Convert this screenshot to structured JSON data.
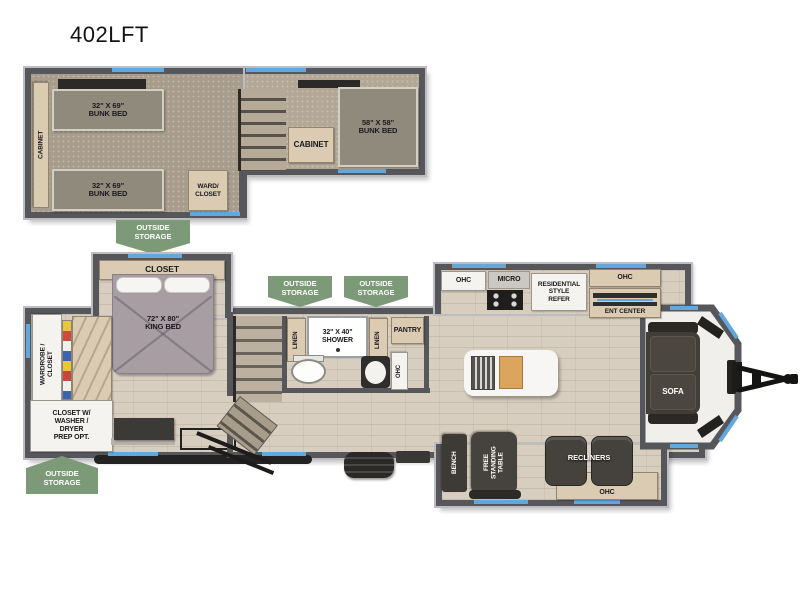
{
  "title": "402LFT",
  "banner": {
    "outside_storage": "OUTSIDE\nSTORAGE"
  },
  "loft": {
    "cabinet": "CABINET",
    "bunk_top": "32\" X 69\"\nBUNK BED",
    "bunk_bottom": "32\" X 69\"\nBUNK BED",
    "ward_closet": "WARD/\nCLOSET",
    "cabinet_mid": "CABINET",
    "bunk_right": "58\" X 58\"\nBUNK BED"
  },
  "bedroom": {
    "closet": "CLOSET",
    "king_bed": "72\" X 80\"\nKING BED",
    "wardrobe": "WARDROBE /\nCLOSET",
    "washer_closet": "CLOSET W/\nWASHER /\nDRYER\nPREP OPT."
  },
  "bath": {
    "linen": "LINEN",
    "shower": "32\" X 40\"\nSHOWER",
    "pantry": "PANTRY",
    "ohc": "OHC"
  },
  "kitchen": {
    "ohc_left": "OHC",
    "micro": "MICRO",
    "refer": "RESIDENTIAL\nSTYLE\nREFER",
    "ohc_right": "OHC",
    "ent_center": "ENT CENTER"
  },
  "living": {
    "sofa": "SOFA",
    "bench": "BENCH",
    "table": "FREE\nSTANDING\nTABLE",
    "recliners": "RECLINERS",
    "ohc": "OHC"
  },
  "colors": {
    "wall": "#56575b",
    "window_blue": "#62a8dc",
    "storage_green": "#7d9a78",
    "floor": "#d8cec0",
    "carpet": "#a89c8c"
  }
}
